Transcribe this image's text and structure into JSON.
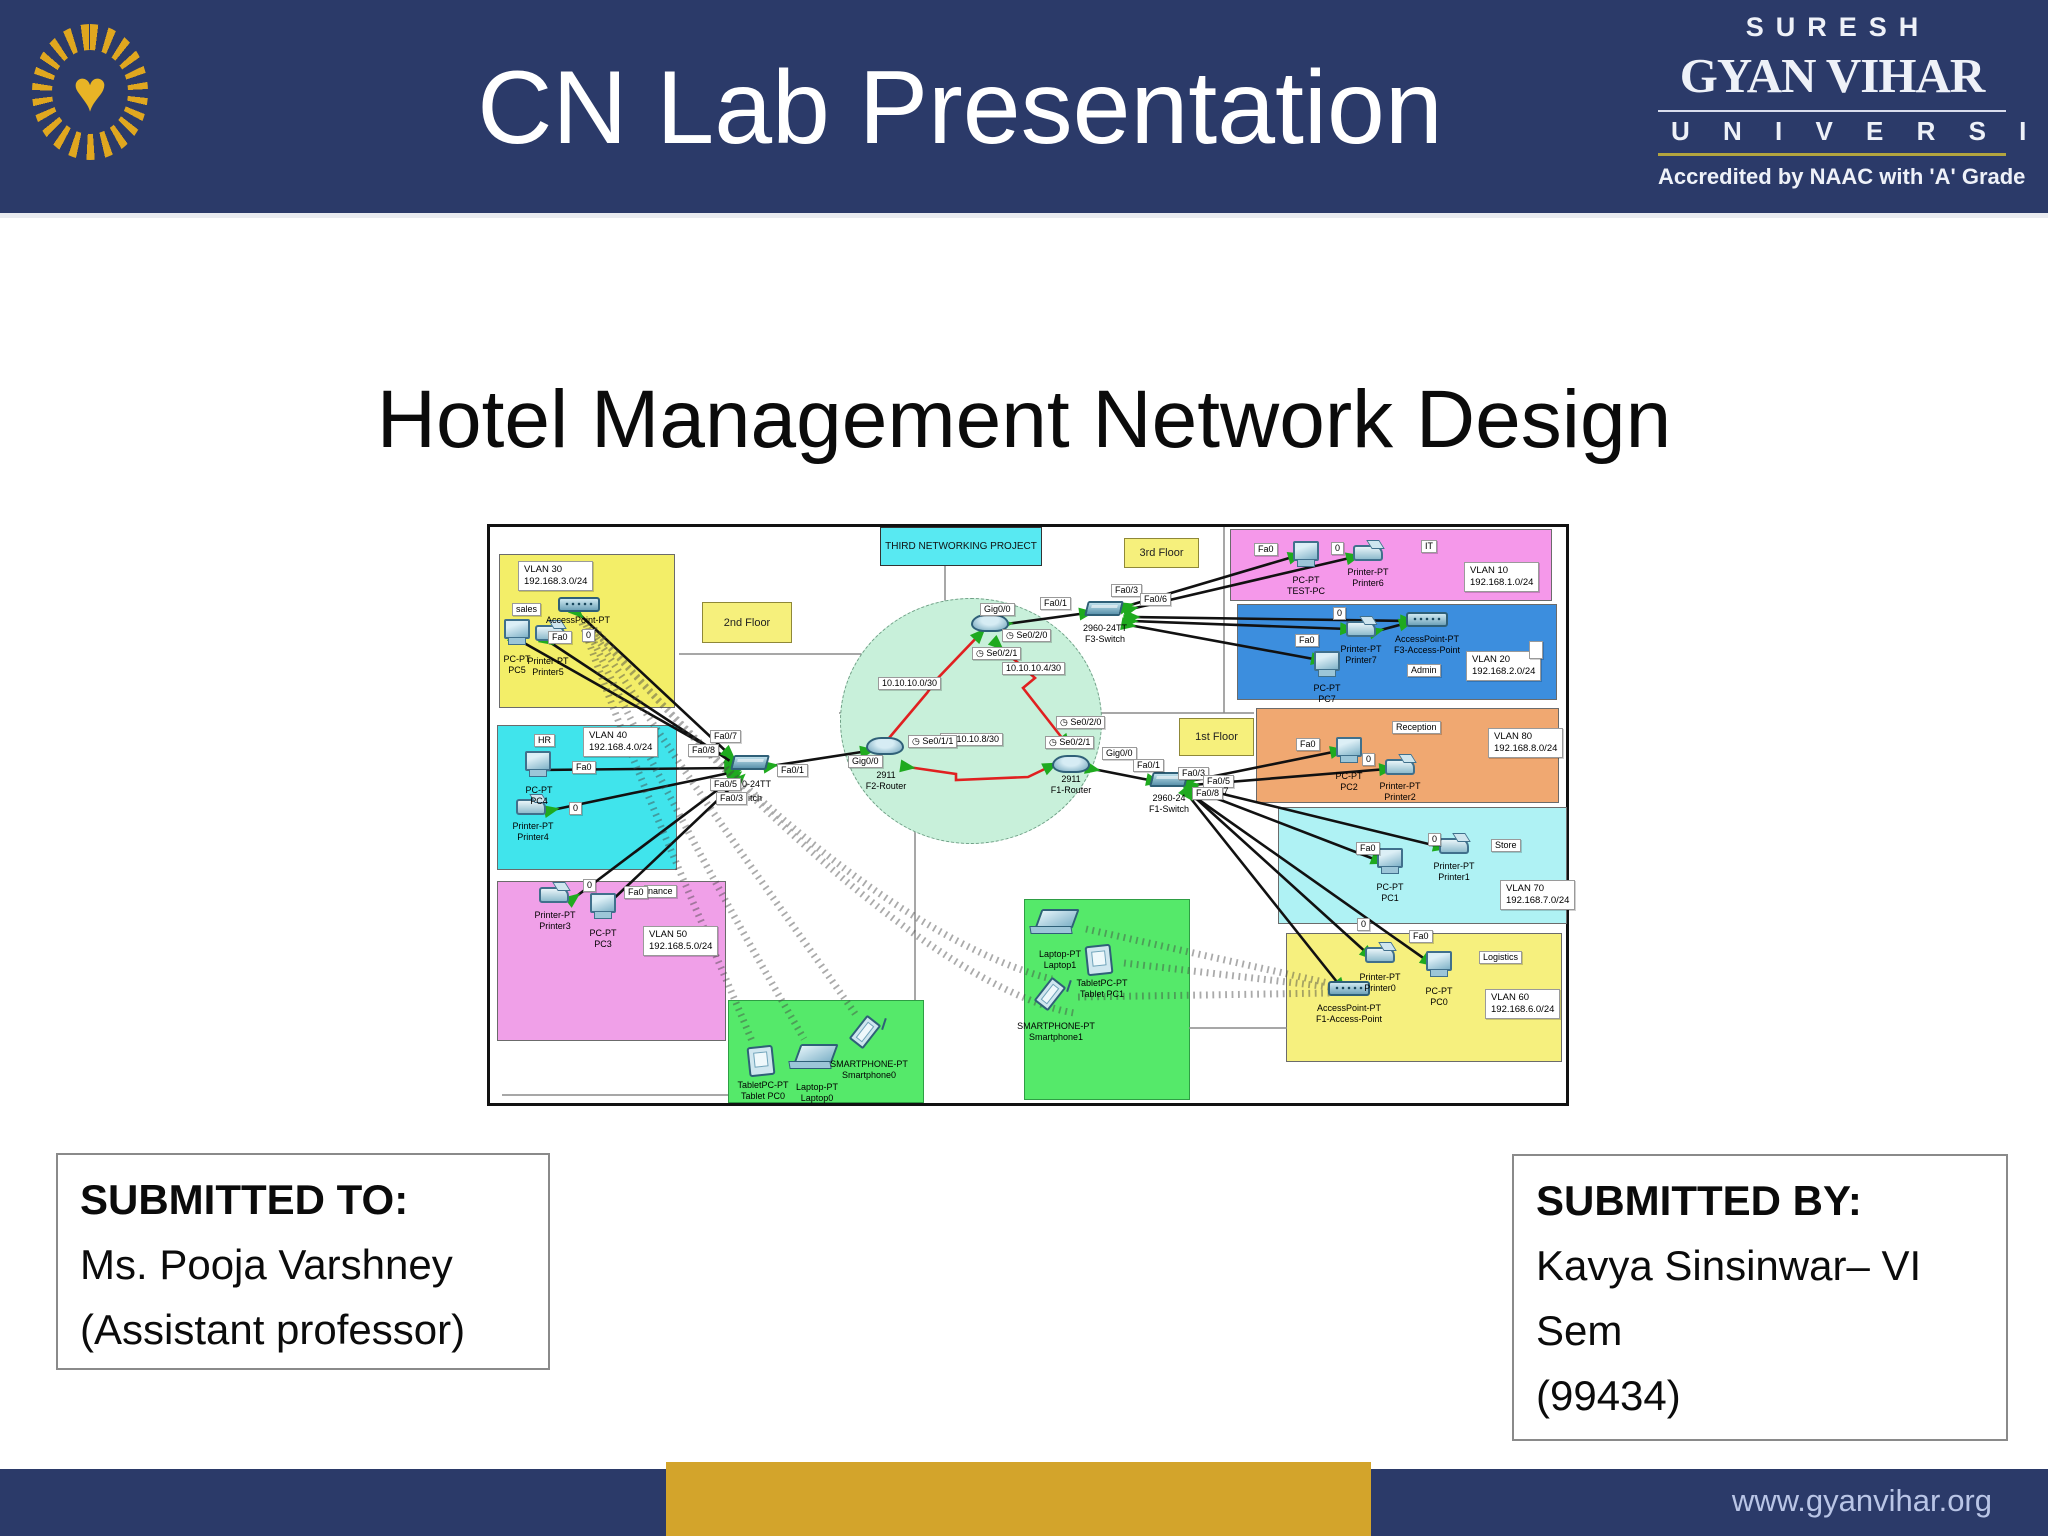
{
  "colors": {
    "navy": "#2b3a69",
    "gold": "#d3a42b",
    "logo_gold": "#e8b426"
  },
  "icons": {
    "logo_heart": "♥"
  },
  "header": {
    "title": "CN Lab Presentation",
    "brand": {
      "line1": "SURESH",
      "line2": "GYAN VIHAR",
      "line3": "U N I V E R S I T Y",
      "line4": "Accredited by NAAC with 'A' Grade"
    }
  },
  "main": {
    "title": "Hotel Management Network Design"
  },
  "submitted_to": {
    "heading": "SUBMITTED TO:",
    "line1": "Ms. Pooja Varshney",
    "line2": "(Assistant professor)"
  },
  "submitted_by": {
    "heading": "SUBMITTED BY:",
    "line1": "Kavya Sinsinwar– VI",
    "line2": "Sem",
    "line3": "(99434)"
  },
  "footer": {
    "url": "www.gyanvihar.org"
  },
  "diagram": {
    "banner": "THIRD NETWORKING PROJECT",
    "floors": {
      "second": "2nd Floor",
      "third": "3rd Floor",
      "first": "1st Floor"
    },
    "nets": {
      "n1": "10.10.10.0/30",
      "n2": "10.10.10.4/30",
      "n3": "10.10.10.8/30"
    },
    "ports": {
      "fa0": "Fa0",
      "p0": "0",
      "fa01": "Fa0/1",
      "fa03": "Fa0/3",
      "fa05": "Fa0/5",
      "fa06": "Fa0/6",
      "fa07": "Fa0/7",
      "fa08": "Fa0/8",
      "p7": "7",
      "gig00": "Gig0/0",
      "se020": "Se0/2/0",
      "se021": "Se0/2/1",
      "se011": "Se0/1/1"
    },
    "vlans": {
      "v30": {
        "info": "VLAN 30\n192.168.3.0/24",
        "dept": "sales"
      },
      "v40": {
        "info": "VLAN 40\n192.168.4.0/24",
        "dept": "HR"
      },
      "v50": {
        "info": "VLAN 50\n192.168.5.0/24",
        "dept": "nance"
      },
      "v10": {
        "info": "VLAN 10\n192.168.1.0/24",
        "dept": "IT"
      },
      "v20": {
        "info": "VLAN 20\n192.168.2.0/24",
        "dept": "Admin"
      },
      "v80": {
        "info": "VLAN 80\n192.168.8.0/24",
        "dept": "Reception"
      },
      "v70": {
        "info": "VLAN 70\n192.168.7.0/24",
        "dept": "Store"
      },
      "v60": {
        "info": "VLAN 60\n192.168.6.0/24",
        "dept": "Logistics"
      }
    },
    "devices": {
      "pc5": "PC-PT\nPC5",
      "printer5": "Printer-PT\nPrinter5",
      "ap30": "AccessPoint-PT",
      "pc4": "PC-PT\nPC4",
      "printer4": "Printer-PT\nPrinter4",
      "pc3": "PC-PT\nPC3",
      "printer3": "Printer-PT\nPrinter3",
      "tablet0": "TabletPC-PT\nTablet PC0",
      "laptop0": "Laptop-PT\nLaptop0",
      "phone0": "SMARTPHONE-PT\nSmartphone0",
      "f2switch_frag1": "0-24TT",
      "f2switch_frag2": "itch",
      "f2router": "2911\nF2-Router",
      "f3switch": "2960-24TT\nF3-Switch",
      "f1router": "2911\nF1-Router",
      "f1switch": "2960-24\nF1-Switch",
      "pctest": "PC-PT\nTEST-PC",
      "printer6": "Printer-PT\nPrinter6",
      "printer7": "Printer-PT\nPrinter7",
      "ap3": "AccessPoint-PT\nF3-Access-Point",
      "pc7": "PC-PT\nPC7",
      "pc2": "PC-PT\nPC2",
      "printer2": "Printer-PT\nPrinter2",
      "pc1": "PC-PT\nPC1",
      "printer1": "Printer-PT\nPrinter1",
      "printer0": "Printer-PT\nPrinter0",
      "pc0": "PC-PT\nPC0",
      "ap1": "AccessPoint-PT\nF1-Access-Point",
      "laptop1": "Laptop-PT\nLaptop1",
      "tablet1": "TabletPC-PT\nTablet PC1",
      "phone1": "SMARTPHONE-PT\nSmartphone1"
    }
  }
}
